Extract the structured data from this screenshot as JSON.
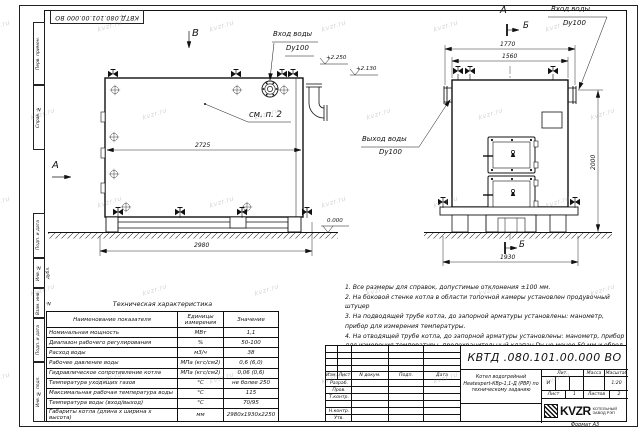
{
  "sheet": {
    "watermark": "kvzr.ru",
    "format_note": "Формат А3"
  },
  "stamp": {
    "doc_number": "КВТД.080.101.00.000 ВО"
  },
  "margin_column": {
    "c1": "Перв. примен.",
    "c2": "Справ. №",
    "c3": "Подп. и дата",
    "c4": "Инв. № дубл.",
    "c5": "Взам. инв. №",
    "c6": "Подп. и дата",
    "c7": "Инв. № подл."
  },
  "labels": {
    "view_b": "В",
    "view_a": "А",
    "sec_b": "Б",
    "inlet": "Вход воды",
    "outlet": "Выход воды",
    "dn": "Dy100",
    "see_item": "см. п. 2",
    "elev_top": "+2.250",
    "elev_mid": "+2.130",
    "elev_zero": "0.000"
  },
  "dims": {
    "side_inner": "2725",
    "side_overall": "2980",
    "front_top_outer": "1770",
    "front_top_inner": "1560",
    "front_width": "1930",
    "front_height": "2000"
  },
  "notes": {
    "items": [
      {
        "text": "1. Все размеры для справок, допустимые отклонения ±100 мм."
      },
      {
        "text": "2. На боковой стенке котла в области топочной камеры установлен продувочный штуцер"
      },
      {
        "text": "3. На подводящей трубе котла, до запорной арматуры установлены: манометр, прибор для измерения температуры."
      },
      {
        "text": "4. На отводящей трубе котла, до запорной арматуры установлены: манометр, прибор для измерения температуры, предохранительный клапан Dу не менее 50 мм и обвод с обратным клапаном Dу не менее 50 мм."
      }
    ]
  },
  "tech_table": {
    "title": "Техническая характеристика",
    "headers": {
      "name": "Наименование показателя",
      "units": "Единицы измерения",
      "value": "Значение"
    },
    "rows": [
      {
        "name": "Номинальная мощность",
        "units": "МВт",
        "value": "1,1"
      },
      {
        "name": "Диапазон рабочего регулирования",
        "units": "%",
        "value": "50-100"
      },
      {
        "name": "Расход воды",
        "units": "м3/ч",
        "value": "38"
      },
      {
        "name": "Рабочее давление воды",
        "units": "МПа (кгс/см2)",
        "value": "0,6 (6,0)"
      },
      {
        "name": "Гидравлическое сопротивление котла",
        "units": "МПа (кгс/см2)",
        "value": "0,06 (0,6)"
      },
      {
        "name": "Температура уходящих газов",
        "units": "°С",
        "value": "не более 250"
      },
      {
        "name": "Максимальная рабочая температура воды",
        "units": "°С",
        "value": "115"
      },
      {
        "name": "Температура воды (вход/выход)",
        "units": "°С",
        "value": "70/95"
      },
      {
        "name": "Габариты котла (длина х ширина х высота)",
        "units": "мм",
        "value": "2980х1930х2250"
      }
    ]
  },
  "title_block": {
    "doc_number": "КВТД .080.101.00.000  ВО",
    "desc1": "Котел водогрейный",
    "desc2": "Heatexpert-КВр-1,1-Д (РВР) по",
    "desc3": "техническому заданию",
    "col_izm": "Изм.",
    "col_list": "Лист",
    "col_doc": "N докум.",
    "col_podp": "Подп.",
    "col_data": "Дата",
    "razrab": "Разраб.",
    "prov": "Пров.",
    "tkontr": "Т.контр.",
    "nkontr": "Н.контр.",
    "utv": "Утв.",
    "lit": "Лит.",
    "massa": "Масса",
    "masshtab": "Масштаб",
    "lit_val": "И",
    "scale_val": "1:20",
    "list_lbl": "Лист",
    "list_val": "1",
    "listov_lbl": "Листов",
    "listov_val": "2",
    "brand": "KVZR",
    "brand_sub1": "КОТЕЛЬНЫЙ",
    "brand_sub2": "ЗАВОД РЭП"
  }
}
